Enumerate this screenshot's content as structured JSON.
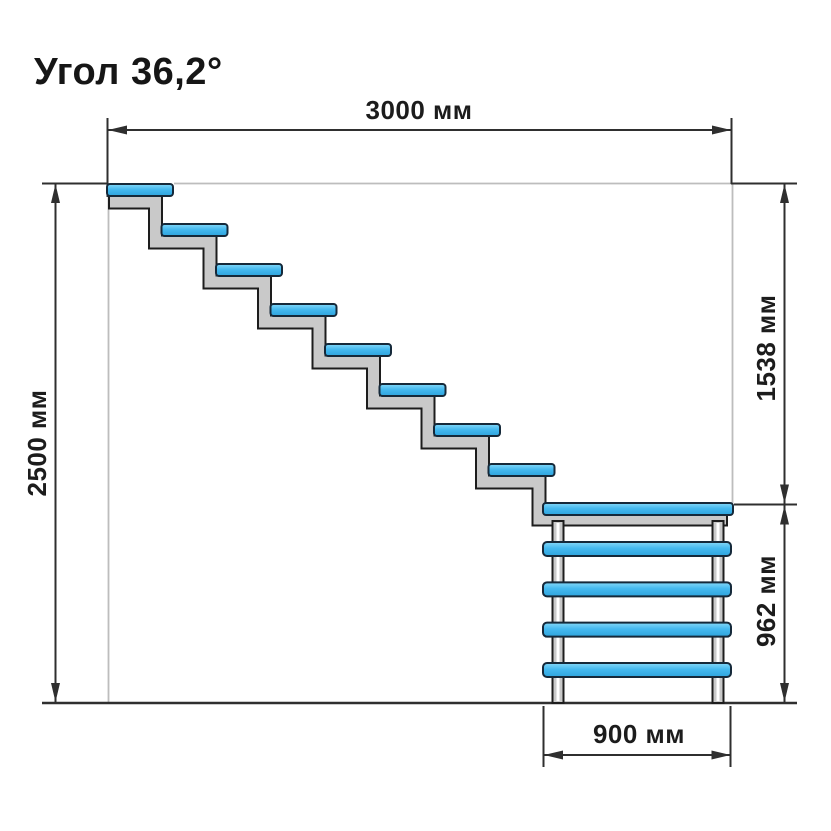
{
  "title": "Угол 36,2°",
  "angle_degrees": 36.2,
  "units": "мм",
  "dimensions": {
    "top": {
      "label": "3000 мм",
      "value": 3000
    },
    "left": {
      "label": "2500 мм",
      "value": 2500
    },
    "right_upper": {
      "label": "1538 мм",
      "value": 1538
    },
    "right_lower": {
      "label": "962 мм",
      "value": 962
    },
    "bottom": {
      "label": "900 мм",
      "value": 900
    }
  },
  "staircase": {
    "flight_steps": 8,
    "landing_rungs": 4
  },
  "colors": {
    "tread_blue_light": "#85d9f8",
    "tread_blue": "#45b9ef",
    "tread_blue_dark": "#2ea4dd",
    "tread_outline": "#15293a",
    "stringer_gray": "#c9c9c9",
    "stringer_outline": "#1d1d1d",
    "dimension_line": "#2f2f2f",
    "reference_line": "#bdbdbd",
    "text": "#1c1c1c"
  }
}
